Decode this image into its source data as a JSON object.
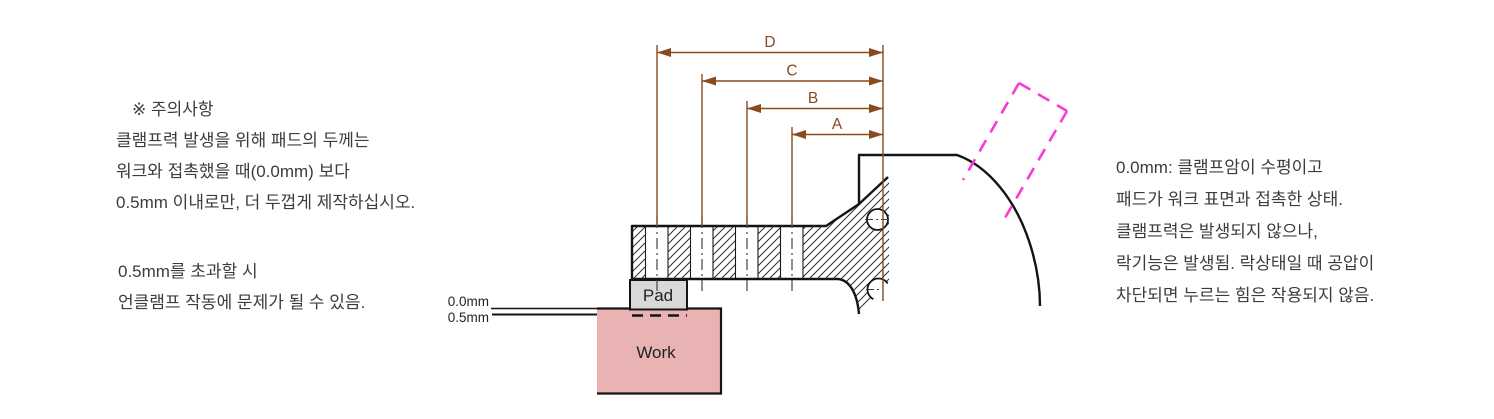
{
  "page": {
    "background": "#ffffff",
    "width": 1494,
    "height": 419
  },
  "left_note": {
    "lines": [
      "※ 주의사항",
      "클램프력 발생을 위해 패드의 두께는",
      "워크와 접촉했을 때(0.0mm) 보다",
      "0.5mm 이내로만, 더 두껍게 제작하십시오."
    ],
    "lines2": [
      "0.5mm를 초과할 시",
      "언클램프 작동에 문제가 될 수 있음."
    ]
  },
  "right_note": {
    "lines": [
      "0.0mm: 클램프암이 수평이고",
      "패드가 워크 표면과 접촉한 상태.",
      "클램프력은 발생되지 않으나,",
      "락기능은 발생됨. 락상태일 때 공압이",
      "차단되면 누르는 힘은 작용되지 않음."
    ]
  },
  "diagram": {
    "dim_labels": [
      "D",
      "C",
      "B",
      "A"
    ],
    "pad_label": "Pad",
    "work_label": "Work",
    "offset_zero_label": "0.0mm",
    "offset_half_label": "0.5mm",
    "colors": {
      "dimension_brown": "#8a4a1e",
      "phantom_magenta": "#f93ad4",
      "work_fill": "#e9b3b3",
      "pad_fill": "#d9d9d9",
      "outline": "#141414",
      "hatch": "#2e2e2e"
    }
  }
}
